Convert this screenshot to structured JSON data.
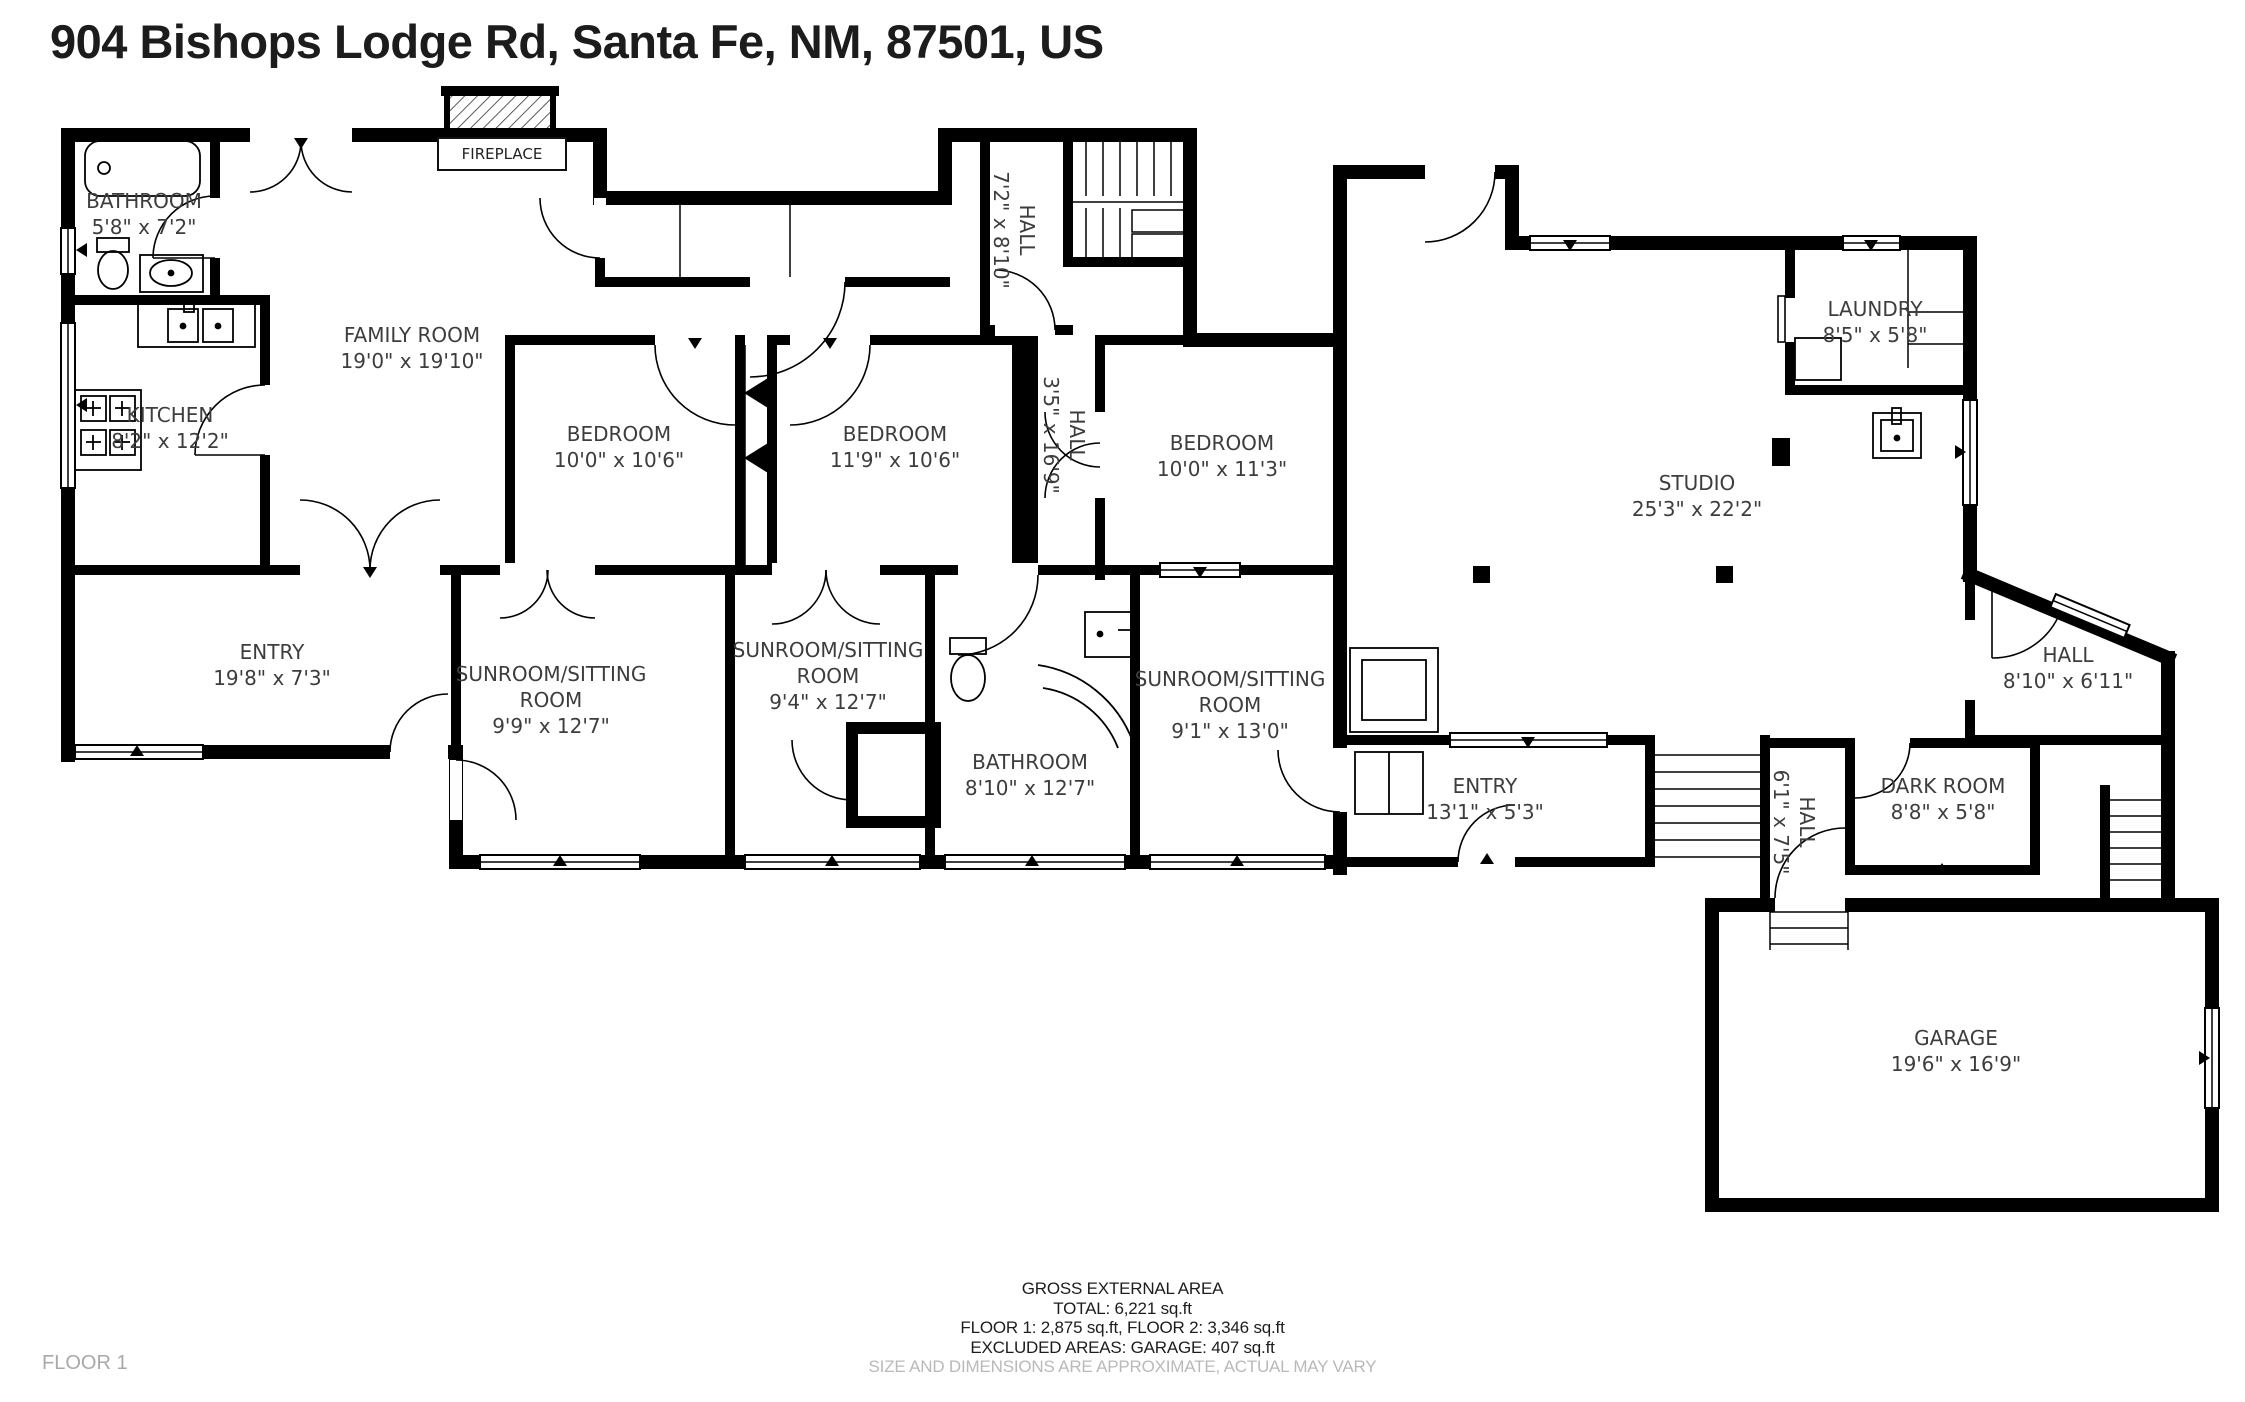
{
  "title": "904 Bishops Lodge Rd, Santa Fe, NM, 87501, US",
  "floor_label": "FLOOR 1",
  "fireplace_label": "FIREPLACE",
  "rooms": [
    {
      "name": "BATHROOM",
      "dims": "5'8\" x 7'2\""
    },
    {
      "name": "KITCHEN",
      "dims": "8'2\" x 12'2\""
    },
    {
      "name": "FAMILY ROOM",
      "dims": "19'0\" x 19'10\""
    },
    {
      "name": "BEDROOM",
      "dims": "10'0\" x 10'6\""
    },
    {
      "name": "BEDROOM",
      "dims": "11'9\" x 10'6\""
    },
    {
      "name": "BEDROOM",
      "dims": "10'0\" x 11'3\""
    },
    {
      "name": "HALL",
      "dims": "7'2\" x 8'10\""
    },
    {
      "name": "HALL",
      "dims": "3'5\" x 16'9\""
    },
    {
      "name": "LAUNDRY",
      "dims": "8'5\" x 5'8\""
    },
    {
      "name": "STUDIO",
      "dims": "25'3\" x 22'2\""
    },
    {
      "name": "ENTRY",
      "dims": "19'8\" x 7'3\""
    },
    {
      "name": "SUNROOM/SITTING ROOM",
      "dims": "9'9\" x 12'7\""
    },
    {
      "name": "SUNROOM/SITTING ROOM",
      "dims": "9'4\" x 12'7\""
    },
    {
      "name": "BATHROOM",
      "dims": "8'10\" x 12'7\""
    },
    {
      "name": "SUNROOM/SITTING ROOM",
      "dims": "9'1\" x 13'0\""
    },
    {
      "name": "ENTRY",
      "dims": "13'1\" x 5'3\""
    },
    {
      "name": "HALL",
      "dims": "8'10\" x 6'11\""
    },
    {
      "name": "DARK ROOM",
      "dims": "8'8\" x 5'8\""
    },
    {
      "name": "HALL",
      "dims": "6'1\" x 7'5\""
    },
    {
      "name": "GARAGE",
      "dims": "19'6\" x 16'9\""
    }
  ],
  "footer": {
    "line1": "GROSS EXTERNAL AREA",
    "line2": "TOTAL: 6,221 sq.ft",
    "line3": "FLOOR 1: 2,875 sq.ft, FLOOR 2: 3,346 sq.ft",
    "line4": "EXCLUDED AREAS: GARAGE: 407 sq.ft",
    "disclaimer": "SIZE AND DIMENSIONS ARE APPROXIMATE, ACTUAL MAY VARY"
  }
}
